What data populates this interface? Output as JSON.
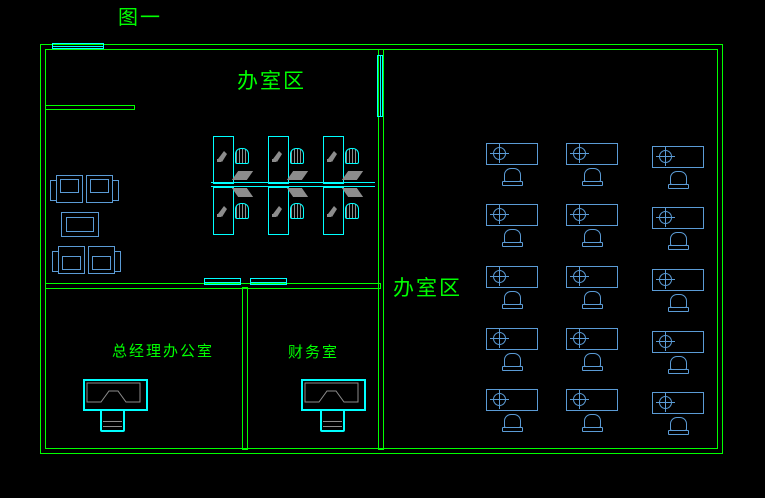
{
  "figure": {
    "label": "图一"
  },
  "labels": {
    "open_office_top": "办室区",
    "open_office_right": "办室区",
    "manager_office": "总经理办公室",
    "finance_room": "财务室"
  },
  "colors": {
    "background": "#000000",
    "wall": "#00ff00",
    "window": "#00ffff",
    "furniture_blue": "#5b9bd5",
    "furniture_cyan": "#00ffff",
    "furniture_gray": "#8c8c8c",
    "label": "#00ff00"
  },
  "right_room_desk_grid": {
    "cols_x": [
      486,
      566,
      652
    ],
    "rows_y": [
      143,
      204,
      266,
      328,
      389
    ],
    "third_col_y_offset": 3,
    "desk_width": 50,
    "desk_height": 20,
    "total_desks": 15
  },
  "workstation_cluster": {
    "columns_x": [
      213,
      268,
      323
    ],
    "top_row_y": 136,
    "bottom_row_y": 187,
    "total_workstations": 6
  }
}
